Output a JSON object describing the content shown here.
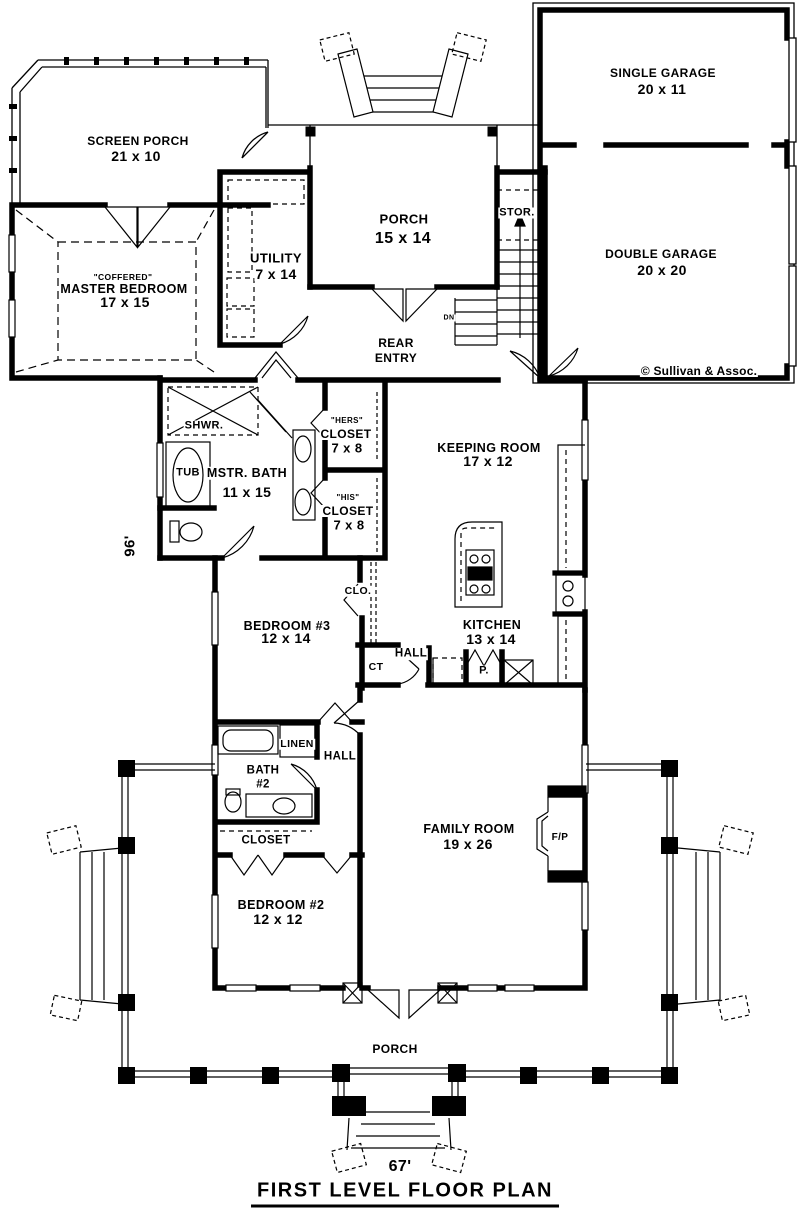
{
  "plan": {
    "title": "FIRST LEVEL FLOOR PLAN",
    "width_dim": "67'",
    "height_dim": "96'",
    "copyright": "© Sullivan & Assoc."
  },
  "rooms": {
    "single_garage": {
      "name": "SINGLE GARAGE",
      "size": "20 x 11"
    },
    "double_garage": {
      "name": "DOUBLE GARAGE",
      "size": "20 x 20"
    },
    "screen_porch": {
      "name": "SCREEN PORCH",
      "size": "21 x 10"
    },
    "master_bedroom": {
      "note": "\"COFFERED\"",
      "name": "MASTER BEDROOM",
      "size": "17 x 15"
    },
    "rear_porch": {
      "name": "PORCH",
      "size": "15 x 14"
    },
    "utility": {
      "name": "UTILITY",
      "size": "7 x 14"
    },
    "storage": {
      "name": "STOR."
    },
    "stairs": {
      "name": "DN"
    },
    "rear_entry": {
      "line1": "REAR",
      "line2": "ENTRY"
    },
    "shower": {
      "name": "SHWR."
    },
    "tub": {
      "name": "TUB"
    },
    "master_bath": {
      "name": "MSTR. BATH",
      "size": "11 x 15"
    },
    "hers_closet": {
      "note": "\"HERS\"",
      "name": "CLOSET",
      "size": "7 x 8"
    },
    "his_closet": {
      "note": "\"HIS\"",
      "name": "CLOSET",
      "size": "7 x 8"
    },
    "keeping_room": {
      "name": "KEEPING ROOM",
      "size": "17 x 12"
    },
    "kitchen": {
      "name": "KITCHEN",
      "size": "13 x 14"
    },
    "pantry": {
      "name": "P."
    },
    "hall_kitchen": {
      "name": "HALL"
    },
    "ct_closet": {
      "name": "CT"
    },
    "clo_closet": {
      "name": "CLO."
    },
    "bedroom3": {
      "name": "BEDROOM #3",
      "size": "12 x 14"
    },
    "linen": {
      "name": "LINEN"
    },
    "hall_bath": {
      "name": "HALL"
    },
    "bath2": {
      "line1": "BATH",
      "line2": "#2"
    },
    "closet2": {
      "name": "CLOSET"
    },
    "family_room": {
      "name": "FAMILY ROOM",
      "size": "19 x 26"
    },
    "fireplace": {
      "name": "F/P"
    },
    "bedroom2": {
      "name": "BEDROOM #2",
      "size": "12 x 12"
    },
    "front_porch": {
      "name": "PORCH"
    }
  }
}
